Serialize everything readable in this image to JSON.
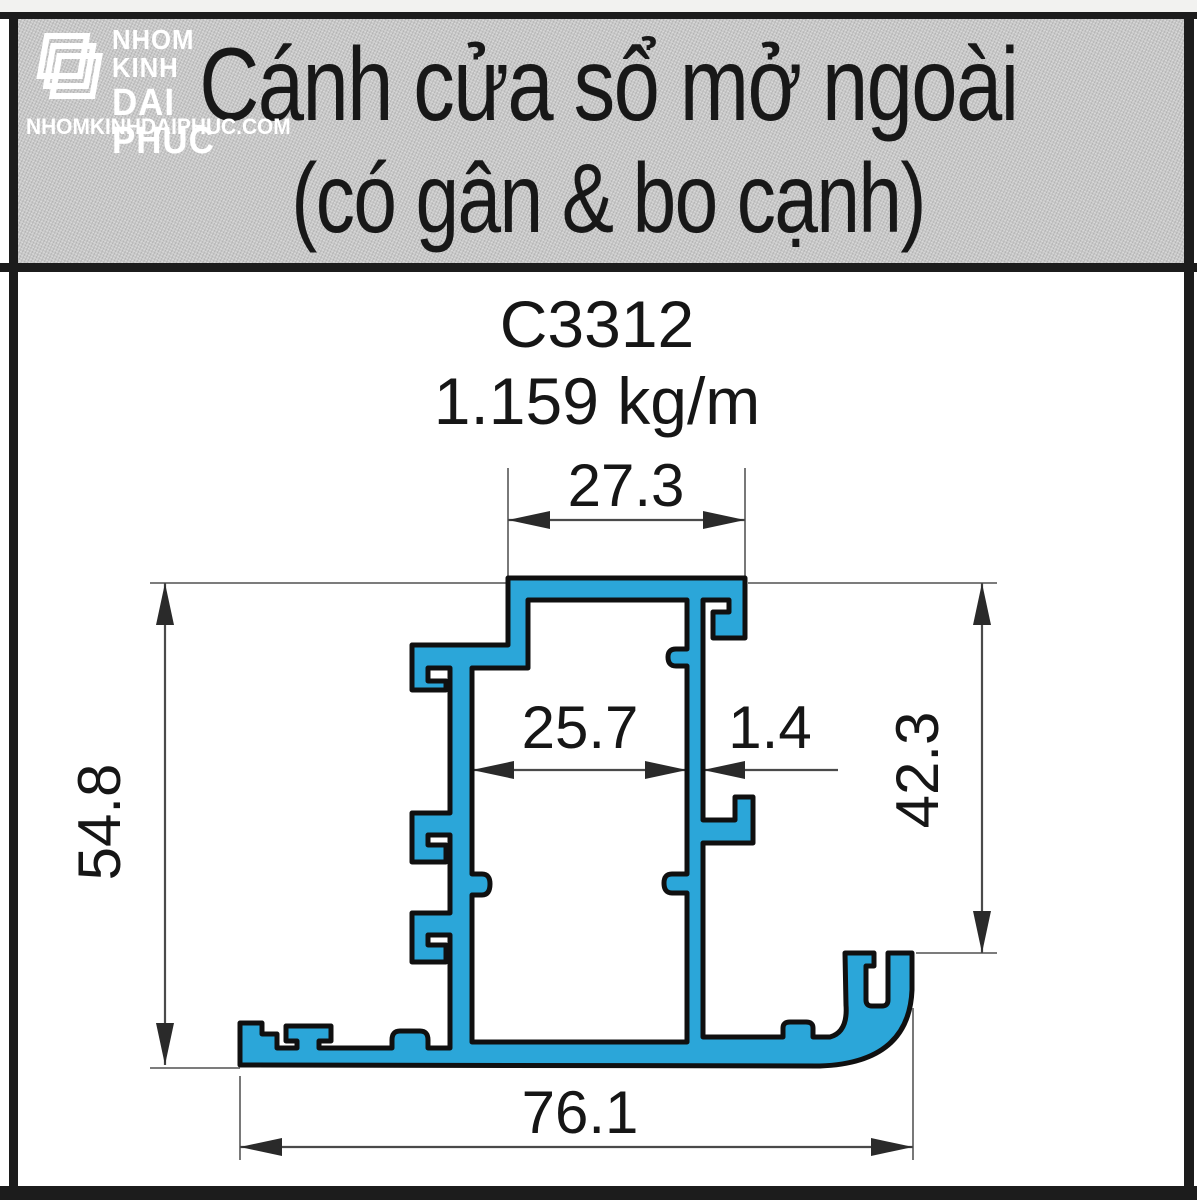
{
  "logo": {
    "name_line1": "NHOM KINH",
    "name_line2": "DAI PHUC",
    "website": "NHOMKINHDAIPHUC.COM"
  },
  "header": {
    "title_line1": "Cánh cửa sổ mở ngoài",
    "title_line2": "(có gân & bo cạnh)"
  },
  "product": {
    "code": "C3312",
    "weight": "1.159 kg/m"
  },
  "dimensions": {
    "top_width": "27.3",
    "cavity_width": "25.7",
    "wall_thickness": "1.4",
    "overall_height": "54.8",
    "right_height": "42.3",
    "overall_width": "76.1"
  },
  "colors": {
    "profile_fill": "#2ba6d9",
    "profile_outline": "#101010",
    "header_background": "#c9c9c9",
    "dimension_line": "#4a4a4a",
    "text": "#161616"
  }
}
